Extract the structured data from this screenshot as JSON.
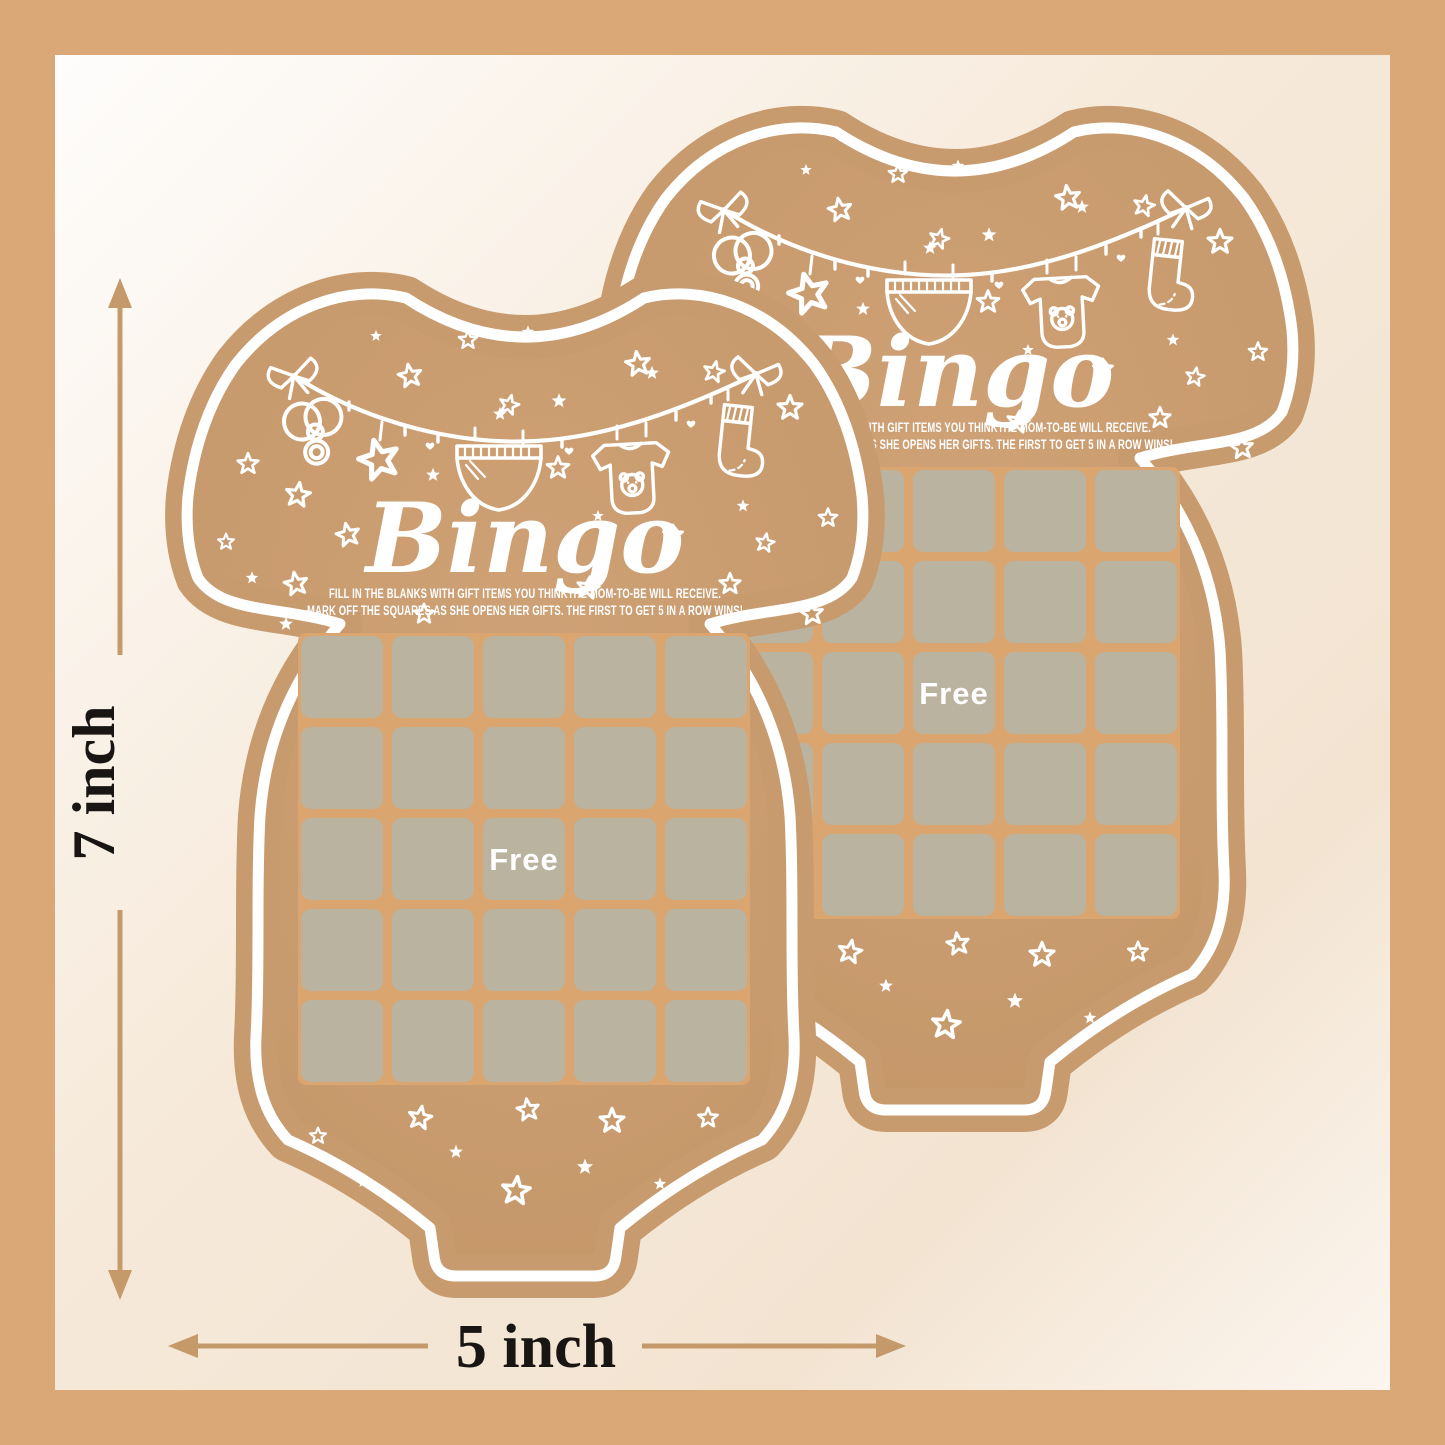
{
  "card": {
    "title": "Bingo",
    "instructions_line1": "FILL IN THE BLANKS WITH GIFT ITEMS YOU THINKTHE MOM-TO-BE WILL RECEIVE.",
    "instructions_line2": "MARK OFF THE SQUARES AS SHE OPENS HER GIFTS. THE FIRST TO GET 5 IN A ROW WINS!",
    "free_label": "Free",
    "grid": {
      "rows": 5,
      "cols": 5,
      "free_position": "center",
      "cell_count": 25
    },
    "material": "kraft paper",
    "shape": "baby-bodysuit"
  },
  "dimensions": {
    "height_label": "7 inch",
    "width_label": "5 inch"
  },
  "decorations": [
    "clothesline",
    "bow",
    "pacifier",
    "hanging-star",
    "diaper",
    "baby-bodysuit",
    "bear-face",
    "sock",
    "stars",
    "hearts"
  ],
  "colors": {
    "frame": "#d9a876",
    "background_white": "#ffffff",
    "background_cream": "#f5e8d8",
    "kraft": "#c89b6e",
    "kraft_light": "#cfa176",
    "grid_square": "#bab3a0",
    "grid_gap": "#daa56f",
    "doodle": "#ffffff",
    "arrow": "#c59a6b",
    "label_text": "#181512"
  }
}
